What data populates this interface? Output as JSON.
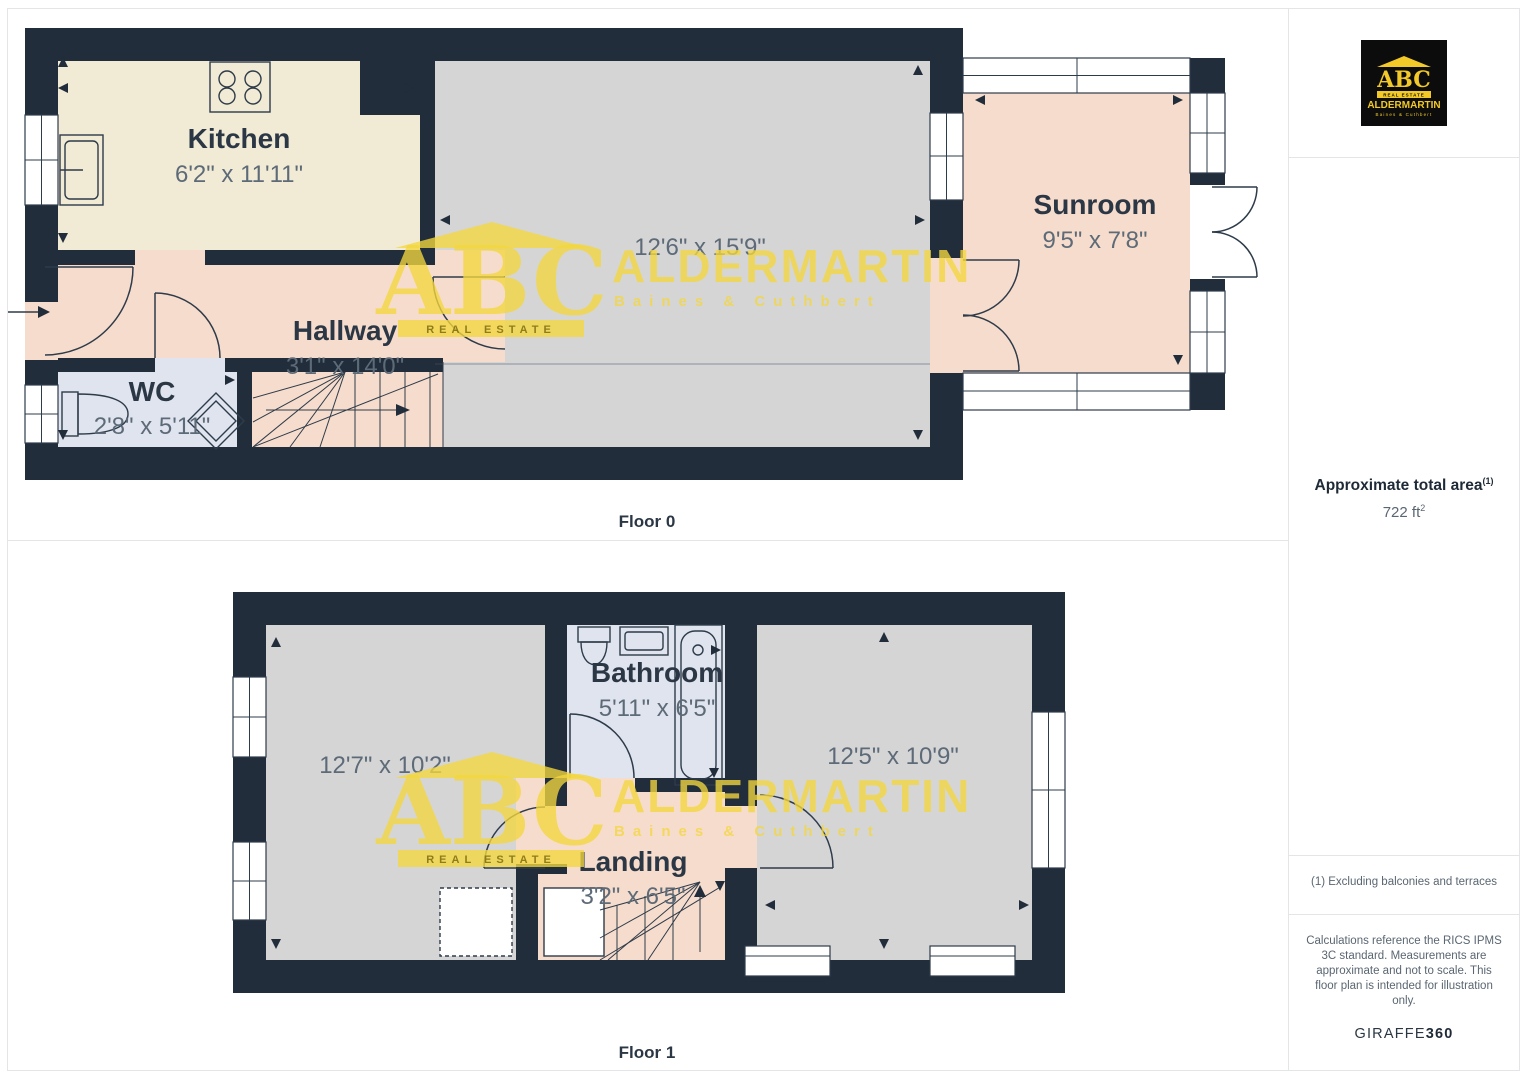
{
  "floors": [
    {
      "label": "Floor 0",
      "rooms": [
        {
          "name": "Kitchen",
          "dims": "6'2\" x 11'11\""
        },
        {
          "name": "Hallway",
          "dims": "3'1\" x 14'0\""
        },
        {
          "name": "WC",
          "dims": "2'8\" x 5'11\""
        },
        {
          "name": "",
          "dims": "12'6\" x 15'9\""
        },
        {
          "name": "Sunroom",
          "dims": "9'5\" x 7'8\""
        }
      ]
    },
    {
      "label": "Floor 1",
      "rooms": [
        {
          "name": "",
          "dims": "12'7\" x 10'2\""
        },
        {
          "name": "Bathroom",
          "dims": "5'11\" x 6'5\""
        },
        {
          "name": "Landing",
          "dims": "3'2\" x 6'5\""
        },
        {
          "name": "",
          "dims": "12'5\" x 10'9\""
        }
      ]
    }
  ],
  "watermark": {
    "abc": "ABC",
    "tagline": "REAL ESTATE",
    "name": "ALDERMARTIN",
    "subname": "Baines & Cuthbert"
  },
  "sidebar": {
    "logo": {
      "abc": "ABC",
      "tagline": "REAL ESTATE",
      "name": "ALDERMARTIN",
      "subname": "Baines & Cuthbert"
    },
    "area_title": "Approximate total area",
    "area_sup": "(1)",
    "area_value": "722 ft",
    "area_value_sup": "2",
    "footnote": "(1) Excluding balconies and terraces",
    "disclaimer_lines": [
      "Calculations reference the RICS IPMS",
      "3C standard. Measurements are",
      "approximate and not to scale. This",
      "floor plan is intended for illustration",
      "only."
    ],
    "brand_normal": "GIRAFFE",
    "brand_bold": "360"
  },
  "colors": {
    "wall": "#212d3b",
    "kitchen": "#f1ead5",
    "hall": "#f6dccc",
    "wc": "#dfe4ef",
    "reception": "#d5d5d6",
    "sunroom": "#f6dccc",
    "bathroom": "#dfe4ef",
    "watermark": "#f4d73e"
  }
}
